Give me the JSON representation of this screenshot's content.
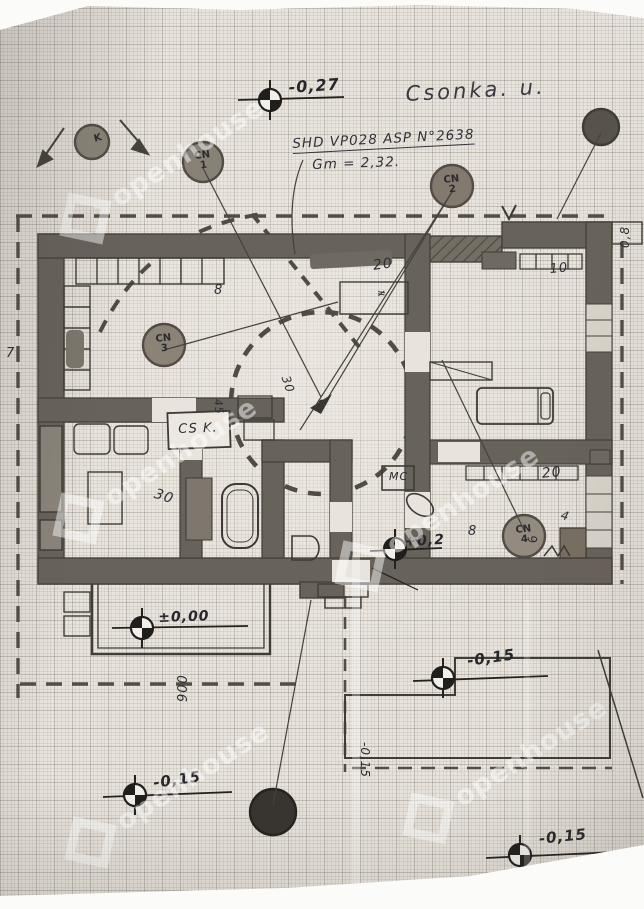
{
  "labels": {
    "street": "Csonka. u.",
    "survey_line1": "SHD VP028 ASP N°2638",
    "survey_line2": "Gm = 2,32.",
    "room_cs": "CS K.",
    "room_mc": "MC"
  },
  "benchmarks": {
    "top": "-0,27",
    "hall": "+0,2",
    "porch": "±0,00",
    "southwest": "-0,15",
    "terrace": "-0,15",
    "southeast": "-0,15"
  },
  "markers": {
    "k": {
      "label": "K"
    },
    "cn1": {
      "name": "CN",
      "num": "1"
    },
    "cn2": {
      "name": "CN",
      "num": "2"
    },
    "cn3": {
      "name": "CN",
      "num": "3"
    },
    "cn4": {
      "name": "CN",
      "num": "4"
    }
  },
  "dimensions": {
    "top_mid_room": "20",
    "top_left_wall": "8",
    "bedroom": "10",
    "se_room": "20",
    "se_wall": "8",
    "se_a": "4",
    "se_b": "9",
    "bath": "45",
    "hall_rot": "30",
    "living": "30",
    "porch_width": "900",
    "left_edge": "7",
    "ne_corner": "0,8",
    "south_rot": "-0,15",
    "hash_note": "≠"
  },
  "watermark": {
    "text": "openhouse"
  }
}
